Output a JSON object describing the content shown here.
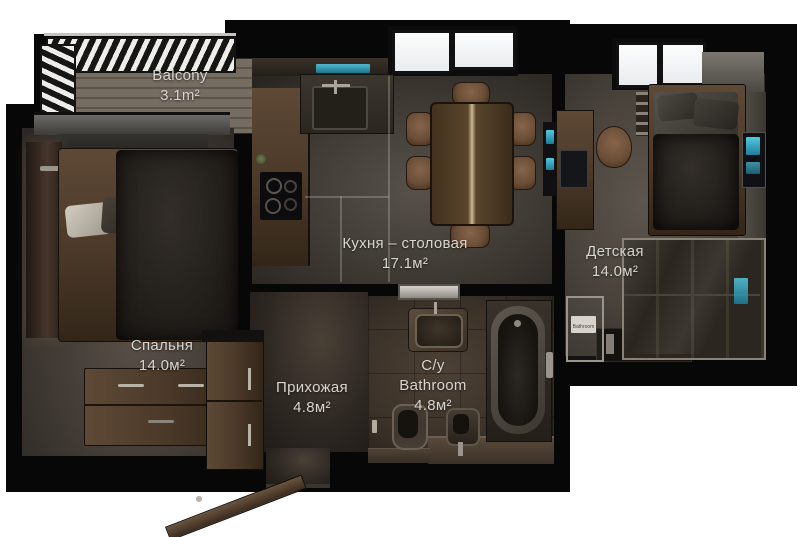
{
  "plan": {
    "type": "apartment-floor-plan",
    "style": "3d-top-down-render"
  },
  "rooms": {
    "balcony": {
      "name": "Balcony",
      "area": "3.1m²"
    },
    "bedroom": {
      "name": "Спальня",
      "area": "14.0м²"
    },
    "kitchen": {
      "name": "Кухня – столовая",
      "area": "17.1м²"
    },
    "nursery": {
      "name": "Детская",
      "area": "14.0м²"
    },
    "hallway": {
      "name": "Прихожая",
      "area": "4.8м²"
    },
    "bathroom": {
      "line1": "С/у",
      "line2": "Bathroom",
      "area": "4.8м²"
    }
  },
  "signs": {
    "bathroom_door": "Bathroom"
  },
  "colors": {
    "background": "#ffffff",
    "walls": "#070707",
    "label_text": "#d9d5cf",
    "wood": "#4a3828",
    "screen_accent": "#54c8e0",
    "deck": "#6e665c"
  }
}
